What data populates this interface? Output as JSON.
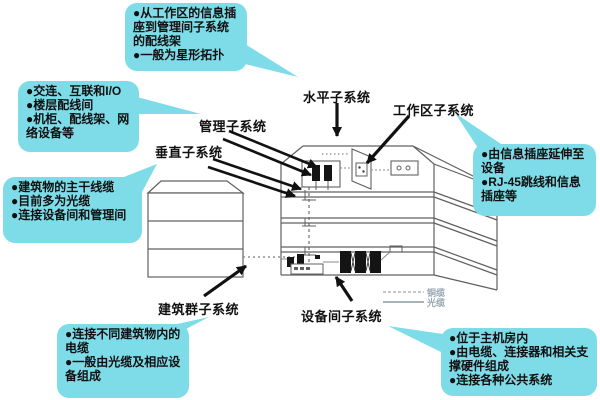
{
  "colors": {
    "callout_bg": "#7edce9",
    "label_text": "#101010",
    "drawing_line": "#606060",
    "arrow": "#111111",
    "legend_text": "#9aa8b4"
  },
  "labels": {
    "horizontal": "水平子系统",
    "work_area": "工作区子系统",
    "management": "管理子系统",
    "vertical": "垂直子系统",
    "campus": "建筑群子系统",
    "equipment": "设备间子系统"
  },
  "callouts": {
    "horizontal_note": {
      "lines": [
        "●从工作区的信息插座到管理间子系统的配线架",
        "●一般为星形拓扑"
      ]
    },
    "management_note": {
      "lines": [
        "●交连、互联和I/O",
        "●楼层配线间",
        "●机柜、配线架、网络设备等"
      ]
    },
    "vertical_note": {
      "lines": [
        "●建筑物的主干线缆",
        "●目前多为光缆",
        "●连接设备间和管理间"
      ]
    },
    "campus_note": {
      "lines": [
        "●连接不同建筑物内的电缆",
        "●一般由光缆及相应设备组成"
      ]
    },
    "work_area_note": {
      "lines": [
        "●由信息插座延伸至设备",
        "●RJ-45跳线和信息插座等"
      ]
    },
    "equipment_note": {
      "lines": [
        "●位于主机房内",
        "●由电缆、连接器和相关支撑硬件组成",
        "●连接各种公共系统"
      ]
    }
  },
  "legend": {
    "copper": "铜缆",
    "fiber": "光缆"
  }
}
